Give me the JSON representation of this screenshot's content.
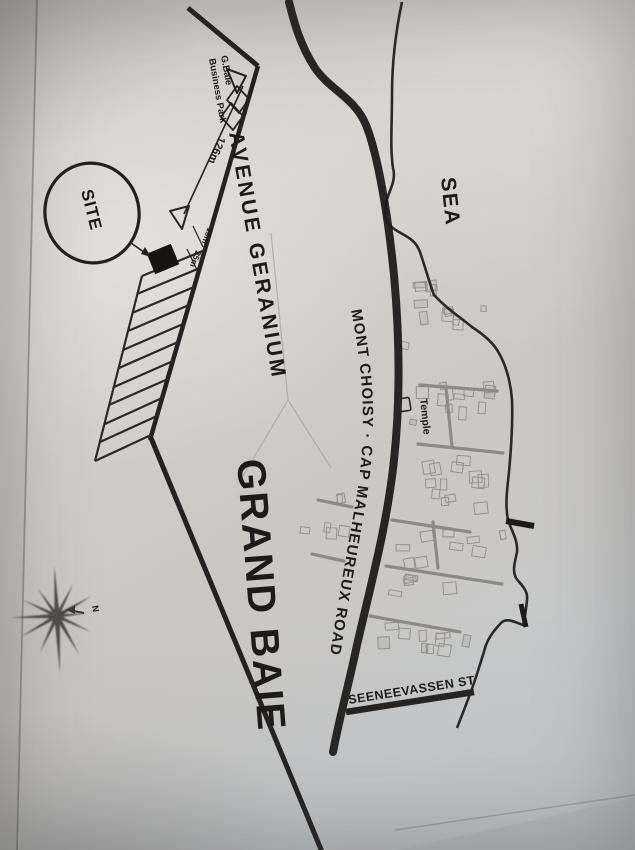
{
  "photo": {
    "description": "Photograph of a printed black-and-white location map / site plan",
    "region": "Grand Baie"
  },
  "labels": {
    "site": "SITE",
    "business_park_line1": "G.Baie",
    "business_park_line2": "Business Park",
    "avenue": "AVENUE GERANIUM",
    "sea": "SEA",
    "main_road": "MONT CHOISY · CAP MALHEUREUX ROAD",
    "temple": "Temple",
    "street": "SEENEEVASSEN ST",
    "town": "GRAND BAIE",
    "north": "N"
  },
  "measurements": {
    "frontage": "126m",
    "plot_width": "19m",
    "plot_depth": "25m"
  },
  "colors": {
    "paper": "#cfccc7",
    "ink": "#1d1b19",
    "street_gray": "#8d8a85",
    "faint_line": "#a9a6a0",
    "building_outline": "#97938c"
  }
}
